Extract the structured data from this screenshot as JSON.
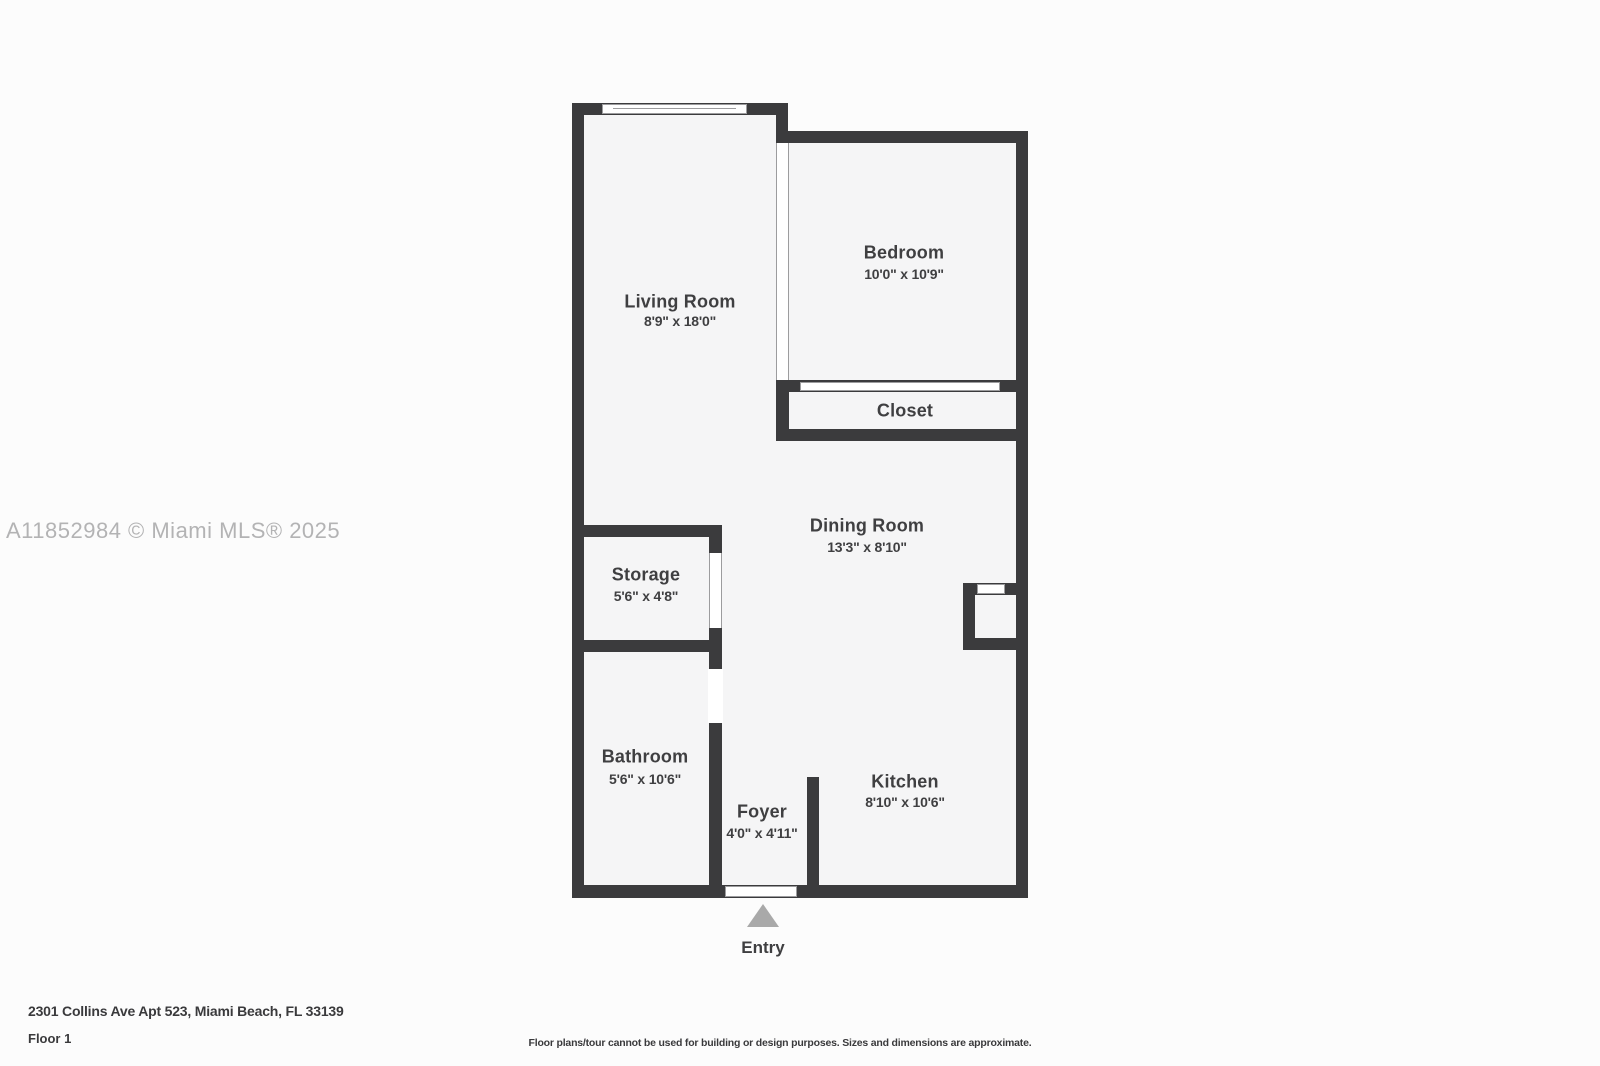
{
  "watermark": "A11852984 © Miami MLS® 2025",
  "plan": {
    "rooms": [
      {
        "name": "Living Room",
        "dims": "8'9\" x 18'0\""
      },
      {
        "name": "Bedroom",
        "dims": "10'0\" x 10'9\""
      },
      {
        "name": "Closet",
        "dims": ""
      },
      {
        "name": "Dining Room",
        "dims": "13'3\" x 8'10\""
      },
      {
        "name": "Storage",
        "dims": "5'6\" x 4'8\""
      },
      {
        "name": "Bathroom",
        "dims": "5'6\" x 10'6\""
      },
      {
        "name": "Foyer",
        "dims": "4'0\" x 4'11\""
      },
      {
        "name": "Kitchen",
        "dims": "8'10\" x 10'6\""
      }
    ],
    "entry_label": "Entry",
    "symbols": {
      "entry_arrow": "triangle-up"
    }
  },
  "footer": {
    "address": "2301 Collins Ave Apt 523, Miami Beach, FL 33139",
    "floor": "Floor 1",
    "disclaimer": "Floor plans/tour cannot be used for building or design purposes. Sizes and dimensions are approximate."
  },
  "colors": {
    "wall": "#3b3b3d",
    "room_fill": "#f5f5f6",
    "page_bg": "#fcfcfc",
    "label": "#3f3f41",
    "watermark": "#b3b3b4",
    "entry_arrow": "#a9a9a9",
    "symbol_line": "#9c9c9e",
    "footer_text": "#3a3a3c"
  }
}
